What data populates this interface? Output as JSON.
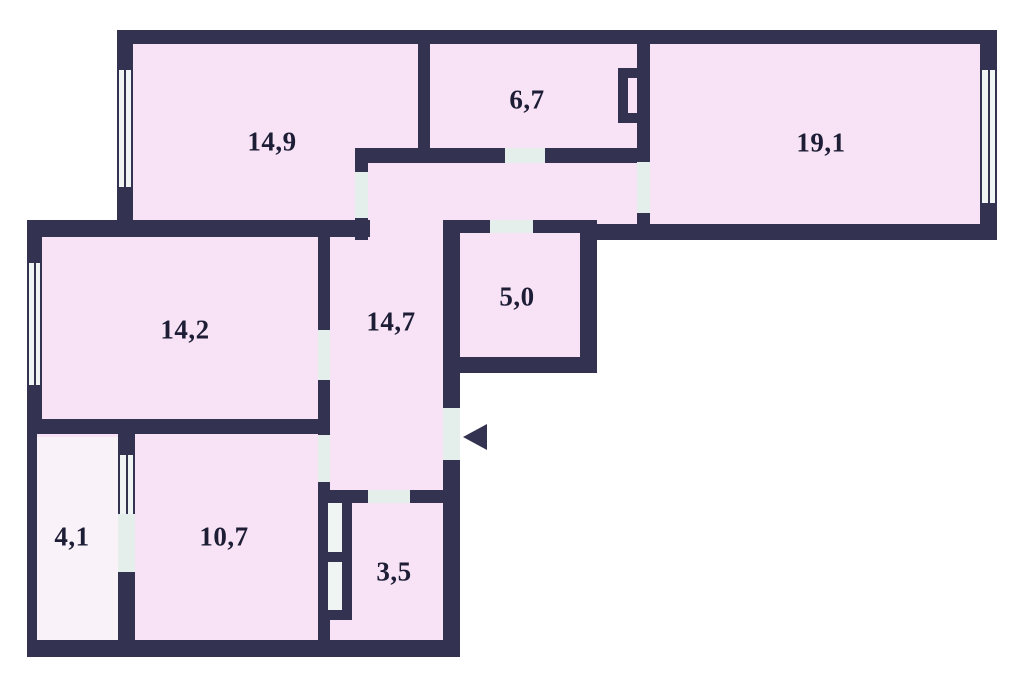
{
  "floorplan": {
    "type": "apartment-floor-plan",
    "colors": {
      "wall": "#333351",
      "room_fill": "#f7e3f5",
      "balcony_fill": "#f9f2f9",
      "opening_fill": "#e4efec",
      "window_fill": "#eef5f3",
      "background": "#ffffff",
      "label_text": "#1d1d36"
    },
    "icons": {
      "entrance_arrow": "triangle-left"
    },
    "rooms": [
      {
        "id": "room-14-9",
        "area_label": "14,9"
      },
      {
        "id": "room-6-7",
        "area_label": "6,7"
      },
      {
        "id": "room-19-1",
        "area_label": "19,1"
      },
      {
        "id": "room-14-2",
        "area_label": "14,2"
      },
      {
        "id": "corridor-14-7",
        "area_label": "14,7"
      },
      {
        "id": "room-5-0",
        "area_label": "5,0"
      },
      {
        "id": "balcony-4-1",
        "area_label": "4,1"
      },
      {
        "id": "room-10-7",
        "area_label": "10,7"
      },
      {
        "id": "room-3-5",
        "area_label": "3,5"
      }
    ]
  }
}
